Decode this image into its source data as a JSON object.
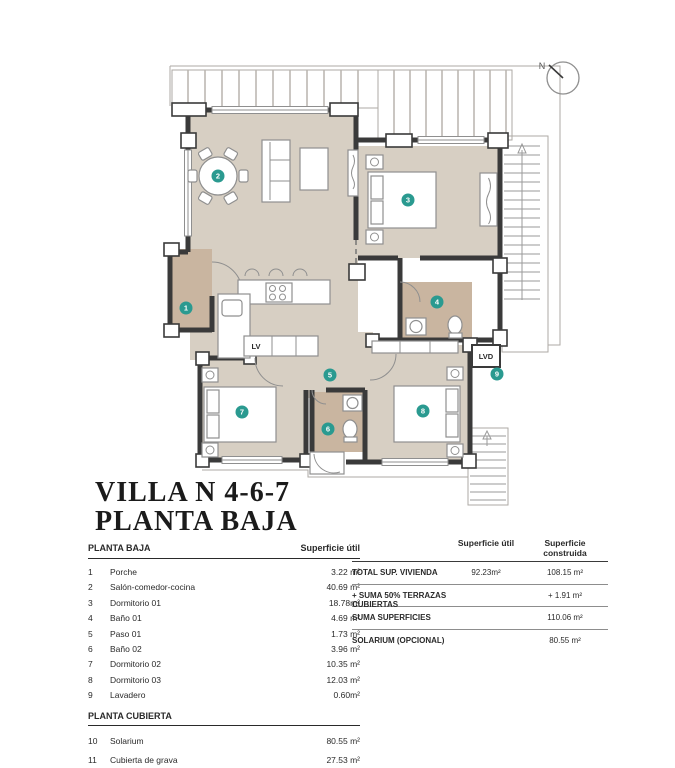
{
  "title": {
    "line1": "VILLA N 4-6-7",
    "line2": "PLANTA BAJA"
  },
  "plan": {
    "compass_label": "N",
    "labels": {
      "lv": "LV",
      "lvd": "LVD"
    },
    "markers": [
      {
        "n": "1",
        "room": "Porche"
      },
      {
        "n": "2",
        "room": "Salón-comedor-cocina"
      },
      {
        "n": "3",
        "room": "Dormitorio 01"
      },
      {
        "n": "4",
        "room": "Baño 01"
      },
      {
        "n": "5",
        "room": "Paso 01"
      },
      {
        "n": "6",
        "room": "Baño 02"
      },
      {
        "n": "7",
        "room": "Dormitorio 02"
      },
      {
        "n": "8",
        "room": "Dormitorio 03"
      },
      {
        "n": "9",
        "room": "Lavadero"
      }
    ],
    "colors": {
      "floor": "#d7cfc3",
      "wet_floor": "#c9b5a0",
      "wall": "#3a3a3a",
      "marker_teal": "#2a9a90"
    }
  },
  "left_table": {
    "header_col1": "PLANTA BAJA",
    "header_col2": "Superficie útil",
    "rows": [
      {
        "num": "1",
        "name": "Porche",
        "value": "3.22 m²"
      },
      {
        "num": "2",
        "name": "Salón-comedor-cocina",
        "value": "40.69 m²"
      },
      {
        "num": "3",
        "name": "Dormitorio 01",
        "value": "18.78m²"
      },
      {
        "num": "4",
        "name": "Baño 01",
        "value": "4.69 m²"
      },
      {
        "num": "5",
        "name": "Paso 01",
        "value": "1.73 m²"
      },
      {
        "num": "6",
        "name": "Baño 02",
        "value": "3.96 m²"
      },
      {
        "num": "7",
        "name": "Dormitorio 02",
        "value": "10.35 m²"
      },
      {
        "num": "8",
        "name": "Dormitorio 03",
        "value": "12.03 m²"
      },
      {
        "num": "9",
        "name": "Lavadero",
        "value": "0.60m²"
      }
    ],
    "subheader": "PLANTA CUBIERTA",
    "rows2": [
      {
        "num": "10",
        "name": "Solarium",
        "value": "80.55 m²"
      },
      {
        "num": "11",
        "name": "Cubierta de grava",
        "value": "27.53 m²"
      }
    ]
  },
  "right_table": {
    "header_util": "Superficie útil",
    "header_constr": "Superficie construida",
    "rows": [
      {
        "label": "TOTAL SUP. VIVIENDA",
        "util": "92.23m²",
        "constr": "108.15 m²"
      },
      {
        "label": "+ SUMA 50% TERRAZAS CUBIERTAS",
        "util": "",
        "constr": "+ 1.91 m²"
      },
      {
        "label": "SUMA SUPERFICIES",
        "util": "",
        "constr": "110.06 m²"
      },
      {
        "label": "SOLARIUM (OPCIONAL)",
        "util": "",
        "constr": "80.55 m²"
      }
    ]
  }
}
